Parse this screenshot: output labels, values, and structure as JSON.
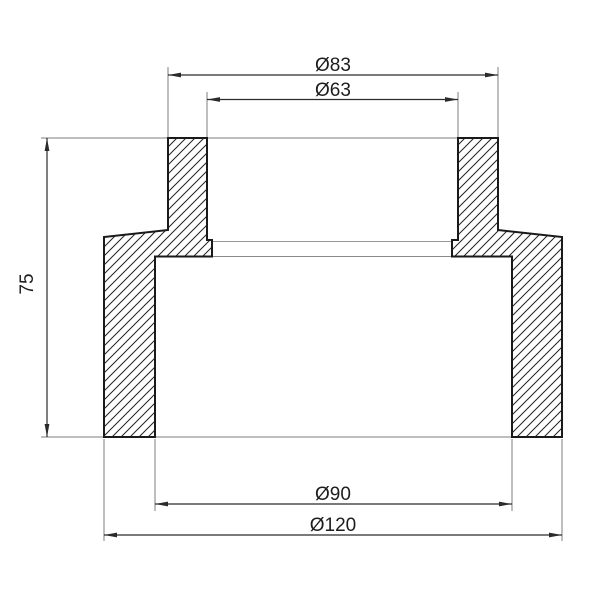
{
  "drawing": {
    "kind": "technical-section-drawing",
    "dims": {
      "top_outer": {
        "label": "Ø83",
        "value": 83
      },
      "top_inner": {
        "label": "Ø63",
        "value": 63
      },
      "height": {
        "label": "75",
        "value": 75
      },
      "bottom_inner": {
        "label": "Ø90",
        "value": 90
      },
      "bottom_outer": {
        "label": "Ø120",
        "value": 120
      }
    },
    "colors": {
      "background": "#ffffff",
      "outline": "#1a1a1a",
      "hatch": "#222222",
      "dimension_line": "#2b2b2b",
      "extension_line": "#7d7d7d",
      "hidden_edge": "#999999",
      "text": "#1d1d1d"
    }
  }
}
